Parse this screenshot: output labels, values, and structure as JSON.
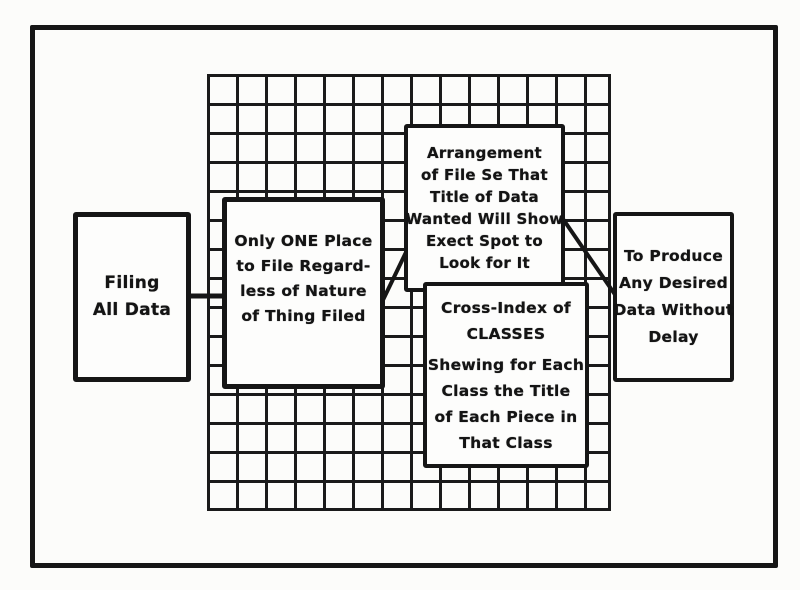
{
  "diagram": {
    "kind": "filing-system-flow-diagram",
    "colors": {
      "paper": "#fcfcfa",
      "ink": "#161616",
      "box_fill": "#fdfdfc"
    },
    "grid": {
      "description": "card-file-grid",
      "columns": 14,
      "rows": 15
    },
    "boxes": {
      "filing": {
        "lines": [
          "Filing",
          "All Data"
        ]
      },
      "oneplace": {
        "lines": [
          "Only ONE Place",
          "to File Regard-",
          "less of Nature",
          "of Thing Filed"
        ]
      },
      "arrangement": {
        "lines": [
          "Arrangement",
          "of File Se That",
          "Title of Data",
          "Wanted Will Show",
          "Exect Spot to",
          "Look for It"
        ]
      },
      "crossindex": {
        "lines": [
          "Cross-Index of",
          "CLASSES",
          "Shewing for Each",
          "Class the Title",
          "of Each Piece in",
          "That Class"
        ]
      },
      "produce": {
        "lines": [
          "To Produce",
          "Any Desired",
          "Data Without",
          "Delay"
        ]
      }
    }
  }
}
